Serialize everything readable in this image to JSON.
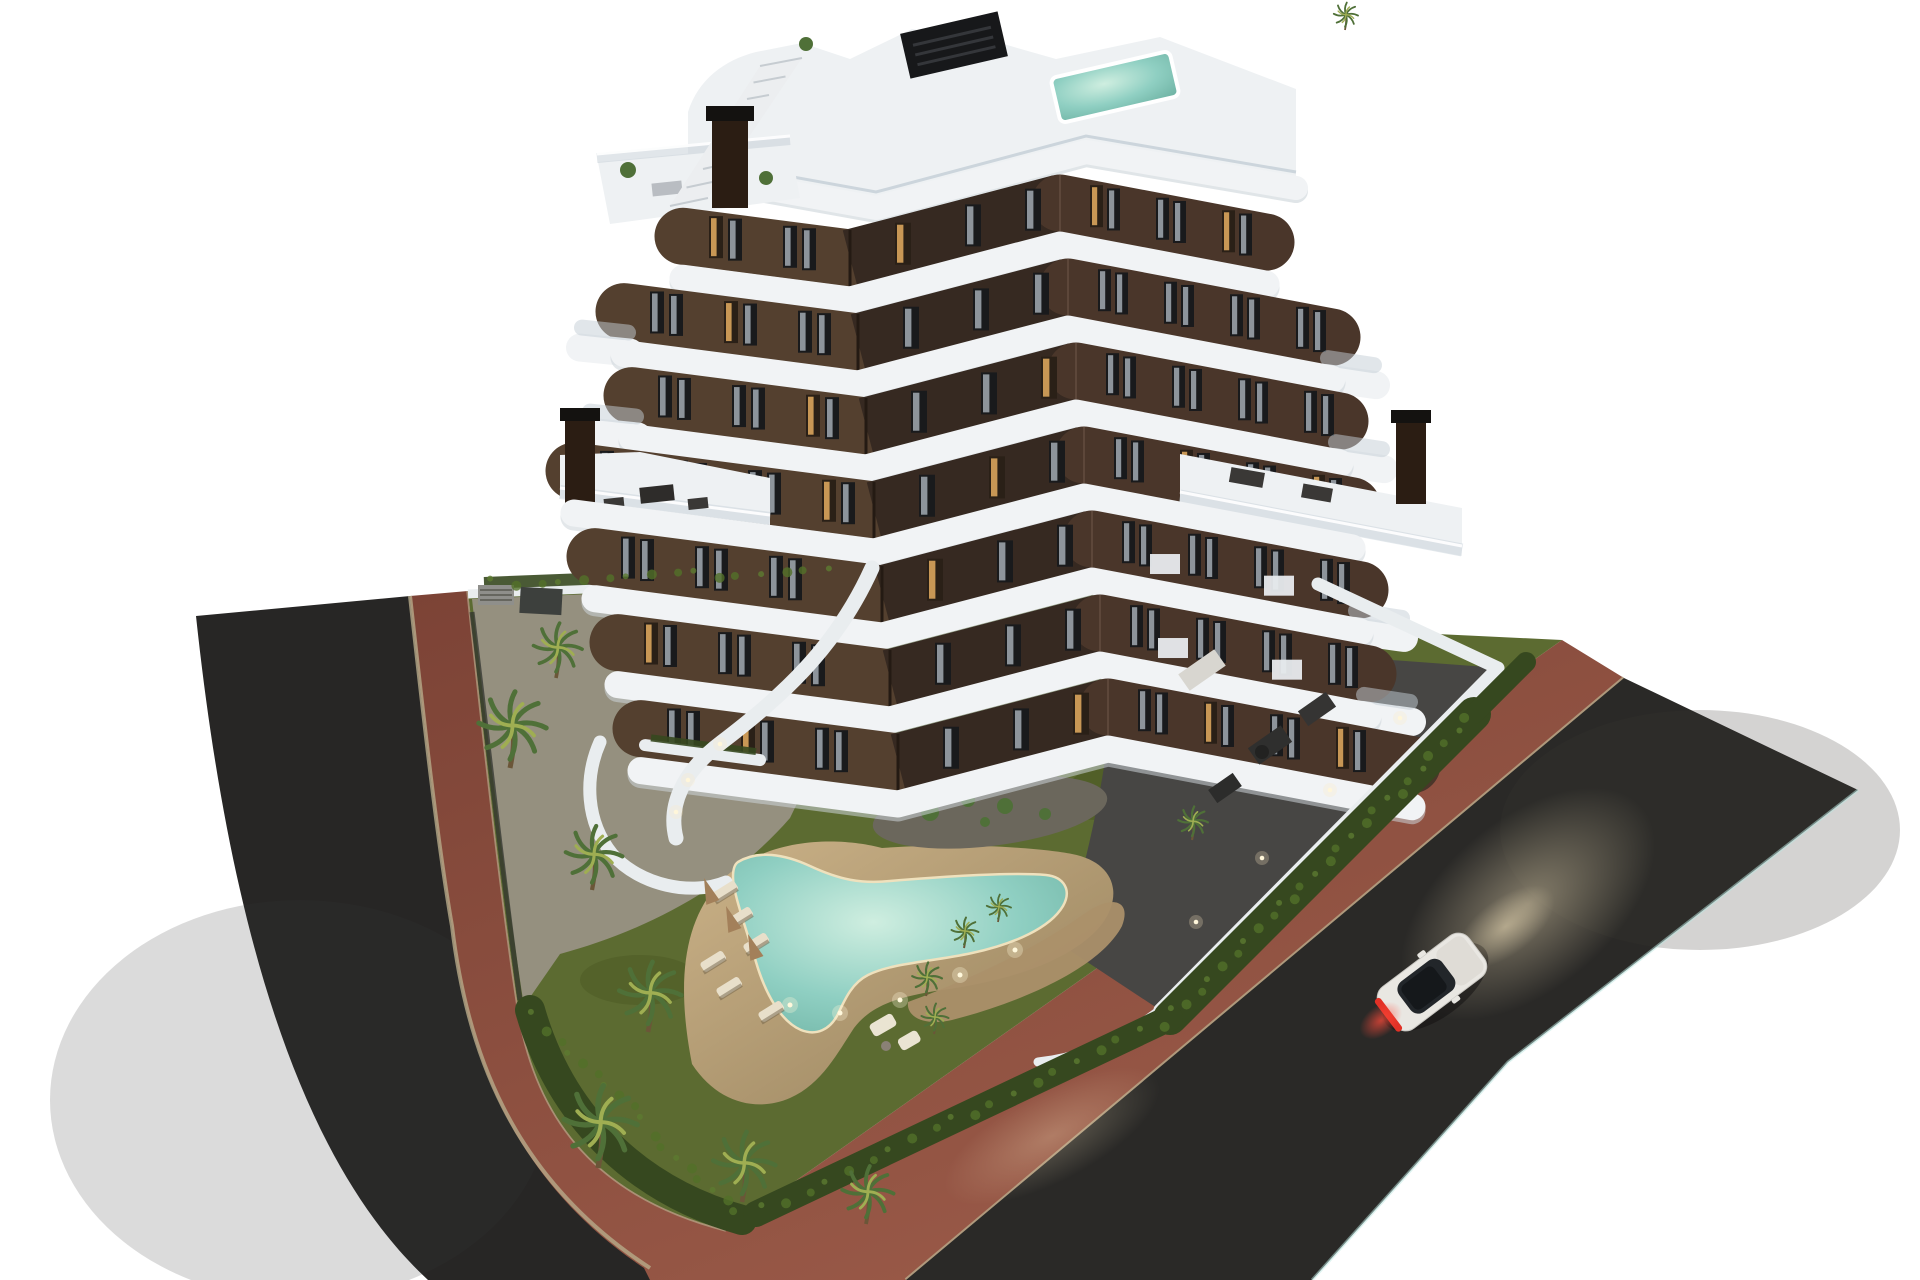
{
  "title": "Aerial dusk 3D architectural render: modern apartment building on a corner plot with garden pool",
  "colors": {
    "background": "#ffffff",
    "asphalt_left": "#272625",
    "asphalt_right": "#2a2927",
    "brick": "#7c4336",
    "brick_light": "#9c5b49",
    "curb": "#b7aa8a",
    "concrete": "#95907f",
    "tile_dark": "#474644",
    "lawn": "#5c6b31",
    "lawn_dark": "#46541f",
    "hedge": "#36481f",
    "hedge_light": "#527029",
    "palm": "#4f7038",
    "palm_light": "#9fae52",
    "trunk": "#6b5638",
    "sand": "#cbb288",
    "sand_dark": "#96815c",
    "gravel": "#6b675c",
    "gravel_warm": "#ab906a",
    "water": "#8fcfc2",
    "water_light": "#cfeee0",
    "water_deep": "#6fb3a4",
    "slab": "#f1f3f5",
    "slab_shadow": "#ccd3d9",
    "glass": "#c3ced6",
    "facade_front": "#54402f",
    "facade_side": "#362921",
    "facade_right": "#4a362a",
    "window": "#191a1c",
    "curtain": "#aab3bb",
    "warm_light": "#d9a45c",
    "roof_deck": "#eef1f3",
    "pergola": "#17181a",
    "chimney": "#2b1d13",
    "wall": "#e9edef",
    "fence": "#31342f",
    "car_body": "#e9e7e2",
    "car_glass": "#22262a",
    "tail_light": "#e23126",
    "glow": "#ffedc4"
  },
  "scene": {
    "setting": "corner plot at dusk surrounded by asphalt streets and red brick sidewalks",
    "building": {
      "type": "modern apartment block",
      "floors_visible": 7,
      "facade": "dark brown walls with white wrap-around curved balcony slabs and glass balustrades",
      "rooftop_features": [
        "plunge pool",
        "roof terrace",
        "external staircase",
        "dark pergola",
        "chimney"
      ]
    },
    "amenities": [
      "free-form swimming pool",
      "sun loungers",
      "closed parasols",
      "lawn",
      "palm trees",
      "perimeter hedge",
      "landscaped island bed",
      "ground floor terraces",
      "communal garden walls with lights"
    ],
    "vehicle": {
      "type": "white coupe",
      "state": "driving on right street, red tail lights lit"
    },
    "roads": {
      "left": "asphalt street",
      "right": "asphalt street",
      "sidewalk": "red brick paving with stone curb"
    },
    "counts": {
      "palm_trees": 13,
      "sun_loungers": 6,
      "parasols": 3,
      "chimneys": 3,
      "cars": 1
    }
  }
}
